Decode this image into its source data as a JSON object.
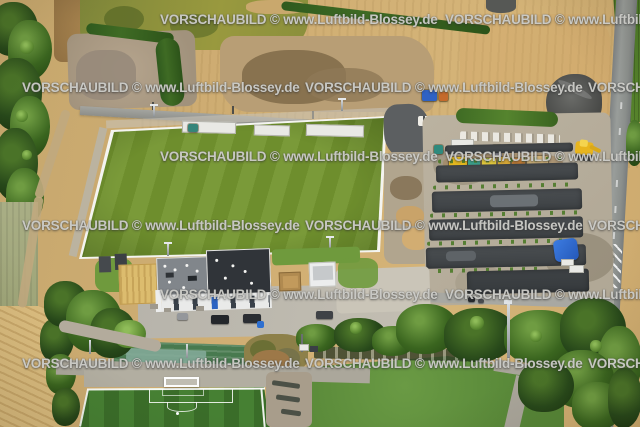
{
  "meta": {
    "width": 640,
    "height": 427,
    "kind": "aerial photograph preview"
  },
  "watermark": {
    "text": "VORSCHAUBILD © www.Luftbild-Blossey.de",
    "color": "#e8e8e4",
    "rows": [
      {
        "y": 12,
        "xs": [
          160,
          445
        ]
      },
      {
        "y": 80,
        "xs": [
          22,
          305,
          588
        ]
      },
      {
        "y": 149,
        "xs": [
          160,
          445
        ]
      },
      {
        "y": 218,
        "xs": [
          22,
          305,
          588
        ]
      },
      {
        "y": 287,
        "xs": [
          160,
          445
        ]
      },
      {
        "y": 356,
        "xs": [
          22,
          305,
          588
        ]
      }
    ]
  },
  "scene": {
    "description": "Oblique aerial view of a new sports complex: main football pitch with floodlights, clubhouse with dark flat roof, parking rows under construction with excavators and a blue tarp, surrounding harvested farm fields, tree lines, allotment garden, artificial turf pitch with goal and penalty box, grass training field and a country road with lane markings",
    "features": [
      "harvested wheat fields",
      "green crop field",
      "tree line along left edge",
      "gravel staging pad with hedges",
      "access road with utility poles",
      "black car on road",
      "main football pitch",
      "floodlight masts",
      "white barrier containers",
      "clubhouse dark flat roof",
      "white utility shed",
      "brown garden shed",
      "sand court",
      "parked cars",
      "blue wheelie bin",
      "parking rows of fresh asphalt",
      "construction machines",
      "site cabin",
      "blue portable toilet",
      "blue tarp",
      "yellow excavator",
      "gravel heap",
      "country road with white hatched marking",
      "hedgerow and tree band",
      "allotment garden with net covers",
      "artificial turf pitch with goal, penalty box and spot",
      "grass training field",
      "footpaths"
    ],
    "palette": {
      "field_beige": "#cdab70",
      "wheat": "#d9bb7e",
      "pitch_green": "#72922f",
      "turf_green": "#3d7029",
      "grass_green": "#689641",
      "crops_green": "#4c7a27",
      "tree_dark": "#2f5a21",
      "tree_light": "#7cab4c",
      "asphalt_dark": "#43474a",
      "gravel_light": "#b6ad9b",
      "road_gray": "#8f938f",
      "roof_dark": "#303439",
      "building_white": "#e9eae9",
      "tarp_blue": "#2f6fd8",
      "machine_yellow": "#e3b71f",
      "sand_yellow": "#dcbc6e"
    }
  }
}
